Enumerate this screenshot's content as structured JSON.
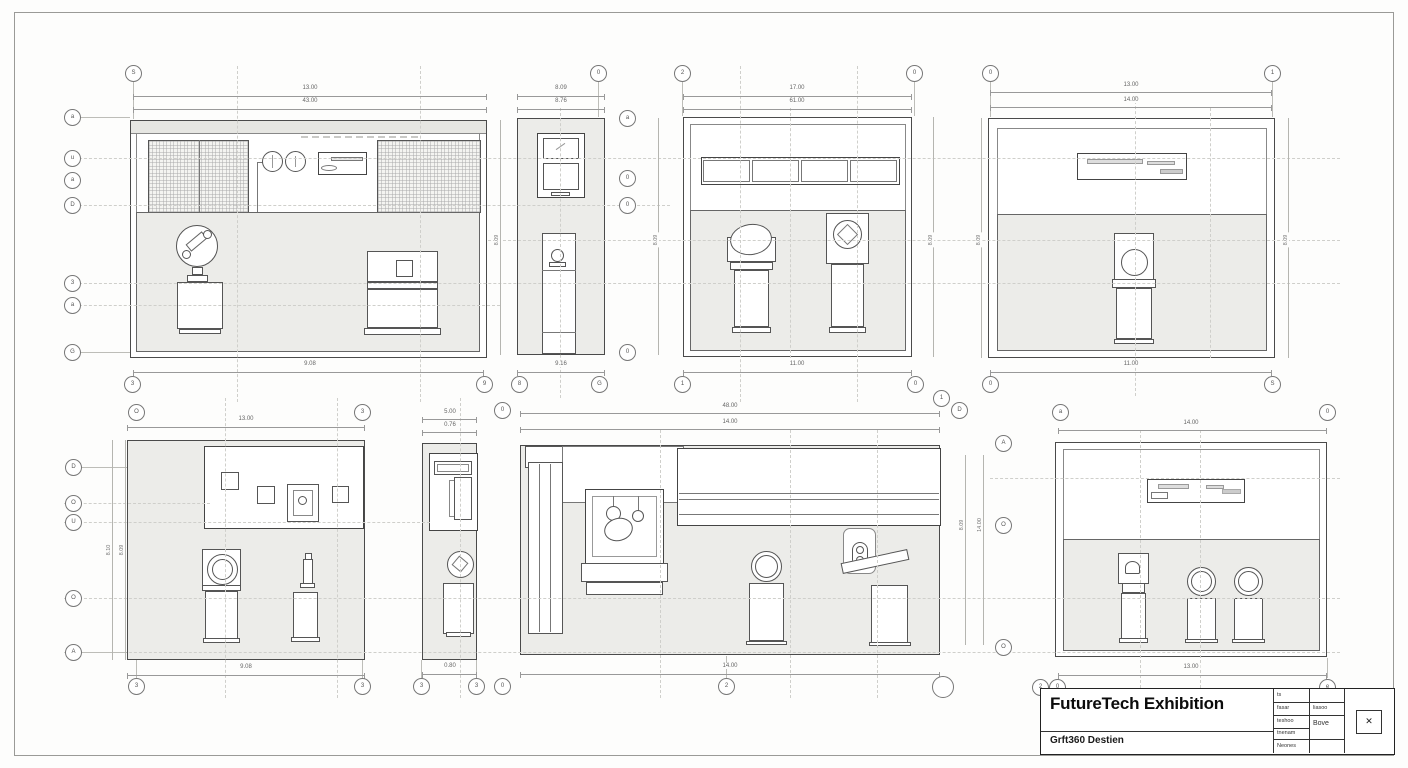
{
  "sheet": {
    "name": "exhibition-elevations-sheet"
  },
  "title_block": {
    "title": "FutureTech Exhibition",
    "subtitle": "Grft360 Destien",
    "rows": [
      {
        "c1": "ts",
        "c2": ""
      },
      {
        "c1": "fasar",
        "c2": "liasoo"
      },
      {
        "c1": "teshoo",
        "c2": "Bove"
      },
      {
        "c1": "tnenam",
        "c2": ""
      },
      {
        "c1": "Neones",
        "c2": ""
      }
    ],
    "stamp": "✕"
  },
  "bubbles": [
    "S",
    "0",
    "2",
    "0",
    "0",
    "1",
    "a",
    "u",
    "a",
    "D",
    "3",
    "a",
    "G",
    "a",
    "0",
    "0",
    "0",
    "3",
    "9",
    "8",
    "G",
    "1",
    "0",
    "0",
    "S",
    "1",
    "D",
    "O",
    "3",
    "0",
    "a",
    "0",
    "D",
    "O",
    "U",
    "O",
    "A",
    "A",
    "O",
    "O",
    "3",
    "3",
    "3",
    "3",
    "0",
    "2",
    "",
    "2",
    "0",
    "e"
  ],
  "dims": [
    "13.00",
    "43.00",
    "9.08",
    "8.09",
    "8.76",
    "9.16",
    "17.00",
    "61.00",
    "11.00",
    "13.00",
    "14.00",
    "11.00",
    "13.00",
    "9.08",
    "5.00",
    "0.76",
    "0.80",
    "48.00",
    "14.00",
    "14.00",
    "14.00",
    "13.00"
  ],
  "vdims": [
    "8.09",
    "8.09",
    "8.09",
    "8.09",
    "8.09",
    "8.10",
    "8.09",
    "8.09",
    "14.00"
  ]
}
